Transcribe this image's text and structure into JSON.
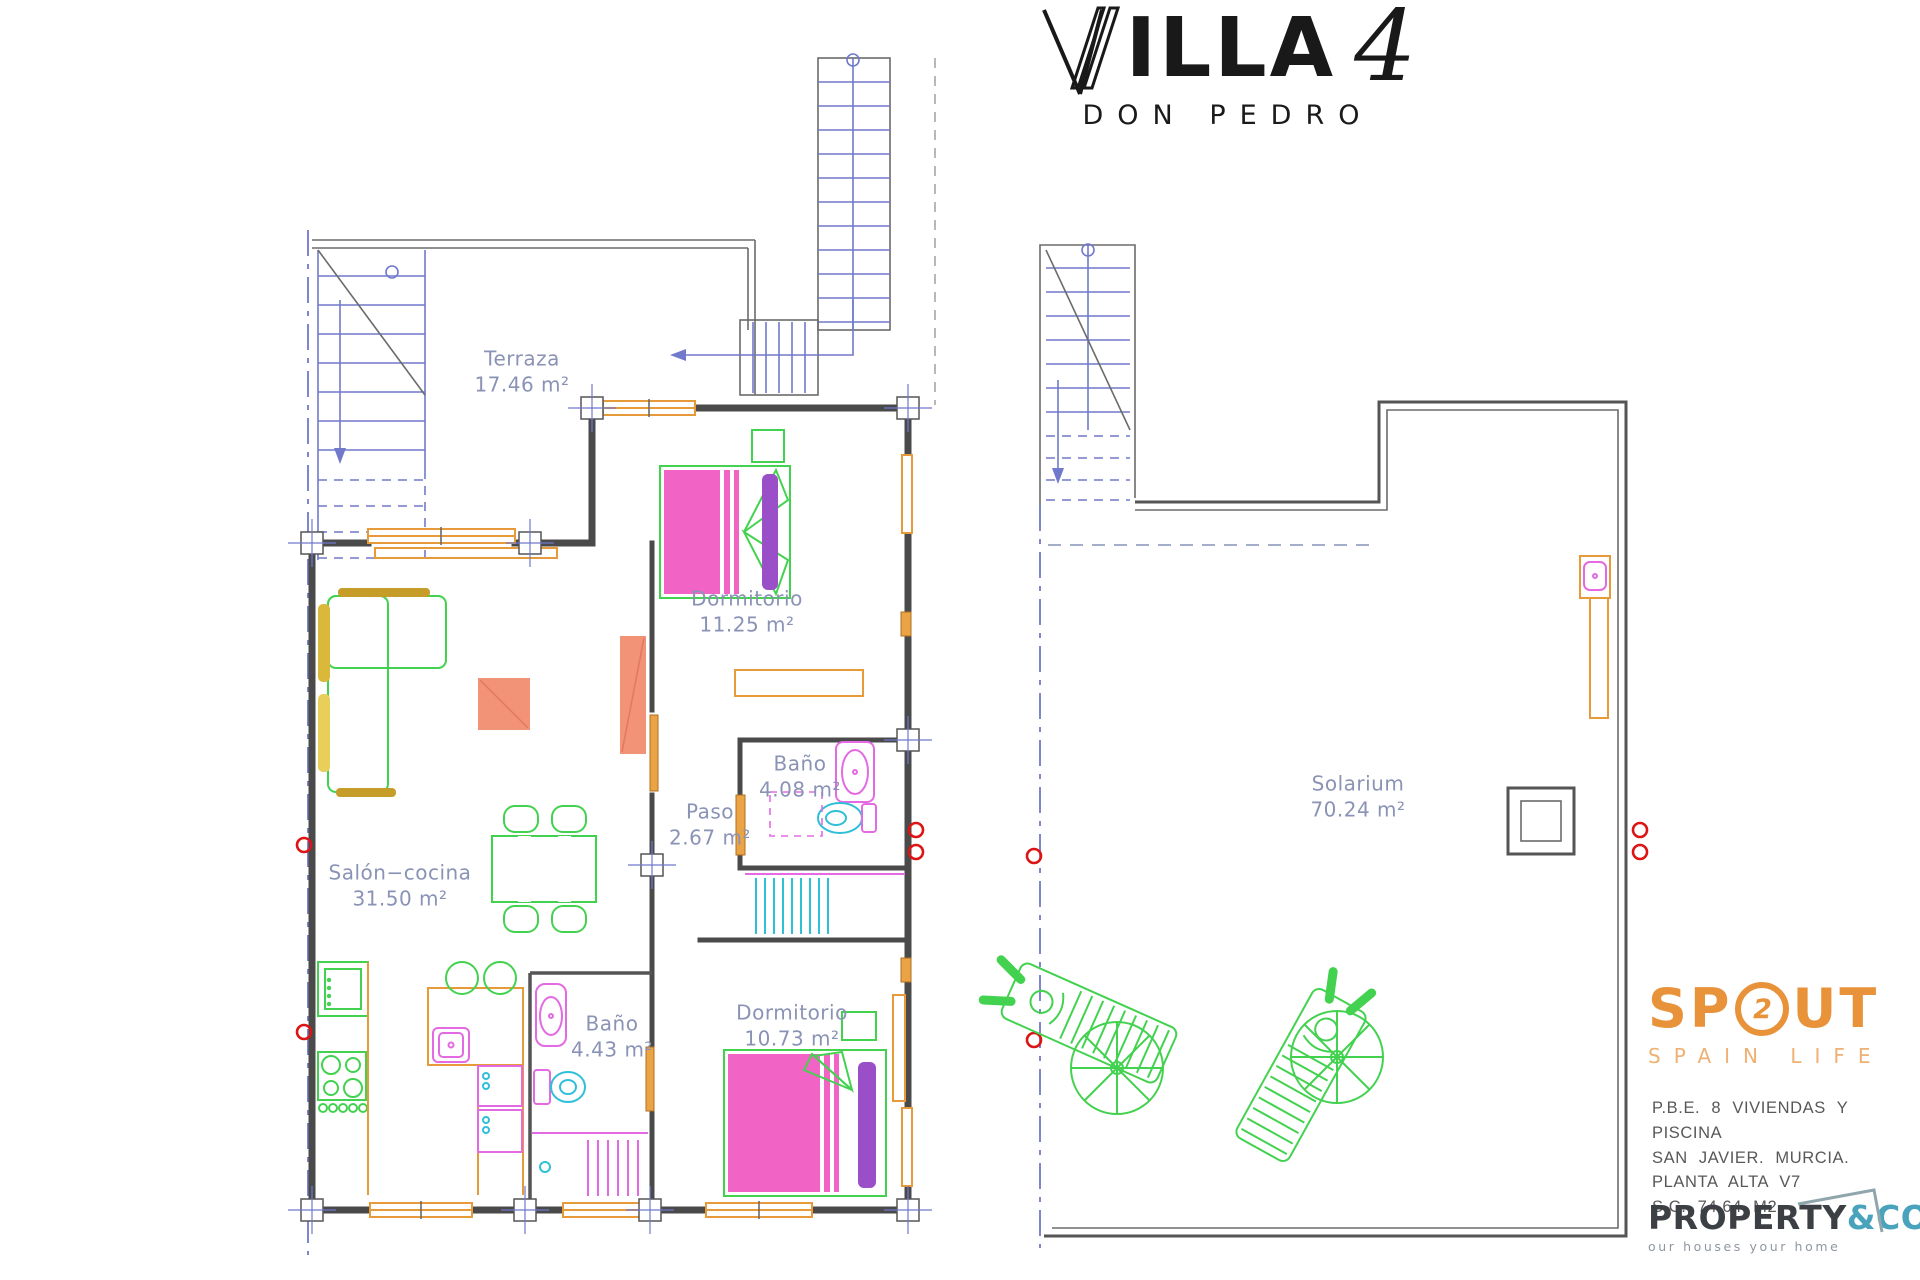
{
  "title": {
    "name_rest": "ILLA",
    "number": "4",
    "subtitle": "DON PEDRO"
  },
  "rooms": {
    "terraza": {
      "name": "Terraza",
      "area": "17.46 m²"
    },
    "dormitorio1": {
      "name": "Dormitorio",
      "area": "11.25 m²"
    },
    "bano1": {
      "name": "Baño",
      "area": "4.08 m²"
    },
    "paso": {
      "name": "Paso",
      "area": "2.67 m²"
    },
    "salon": {
      "name": "Salón−cocina",
      "area": "31.50 m²"
    },
    "bano2": {
      "name": "Baño",
      "area": "4.43 m²"
    },
    "dormitorio2": {
      "name": "Dormitorio",
      "area": "10.73 m²"
    },
    "solarium": {
      "name": "Solarium",
      "area": "70.24 m²"
    }
  },
  "branding": {
    "spout": {
      "prefix": "SP",
      "icon_glyph": "2",
      "suffix": "UT",
      "tagline": "SPAIN LIFE"
    },
    "project_info": {
      "lines": [
        "P.B.E. 8 VIVIENDAS Y PISCINA",
        "SAN JAVIER. MURCIA.",
        "PLANTA ALTA V7",
        "S.C. 74.64 M2"
      ]
    },
    "property_co": {
      "name": "PROPERTY",
      "suffix": "&CO",
      "tagline": "our houses your home"
    }
  },
  "colors": {
    "walls": "#4a4a4a",
    "stairs_blue": "#7079cc",
    "label_text": "#8a93b5",
    "carpentry_orange": "#e79a3a",
    "furniture_green": "#43d24f",
    "bed_pink": "#f263c6",
    "pillow_purple": "#9a4fc8",
    "fixture_magenta": "#e36ae3",
    "fixture_cyan": "#2fc0d8",
    "sofa_yellow": "#e8cf5a",
    "table_salmon": "#f29277",
    "survey_red": "#dd1414",
    "brand_orange": "#e8923a",
    "brand_teal": "#4aa3bd"
  }
}
